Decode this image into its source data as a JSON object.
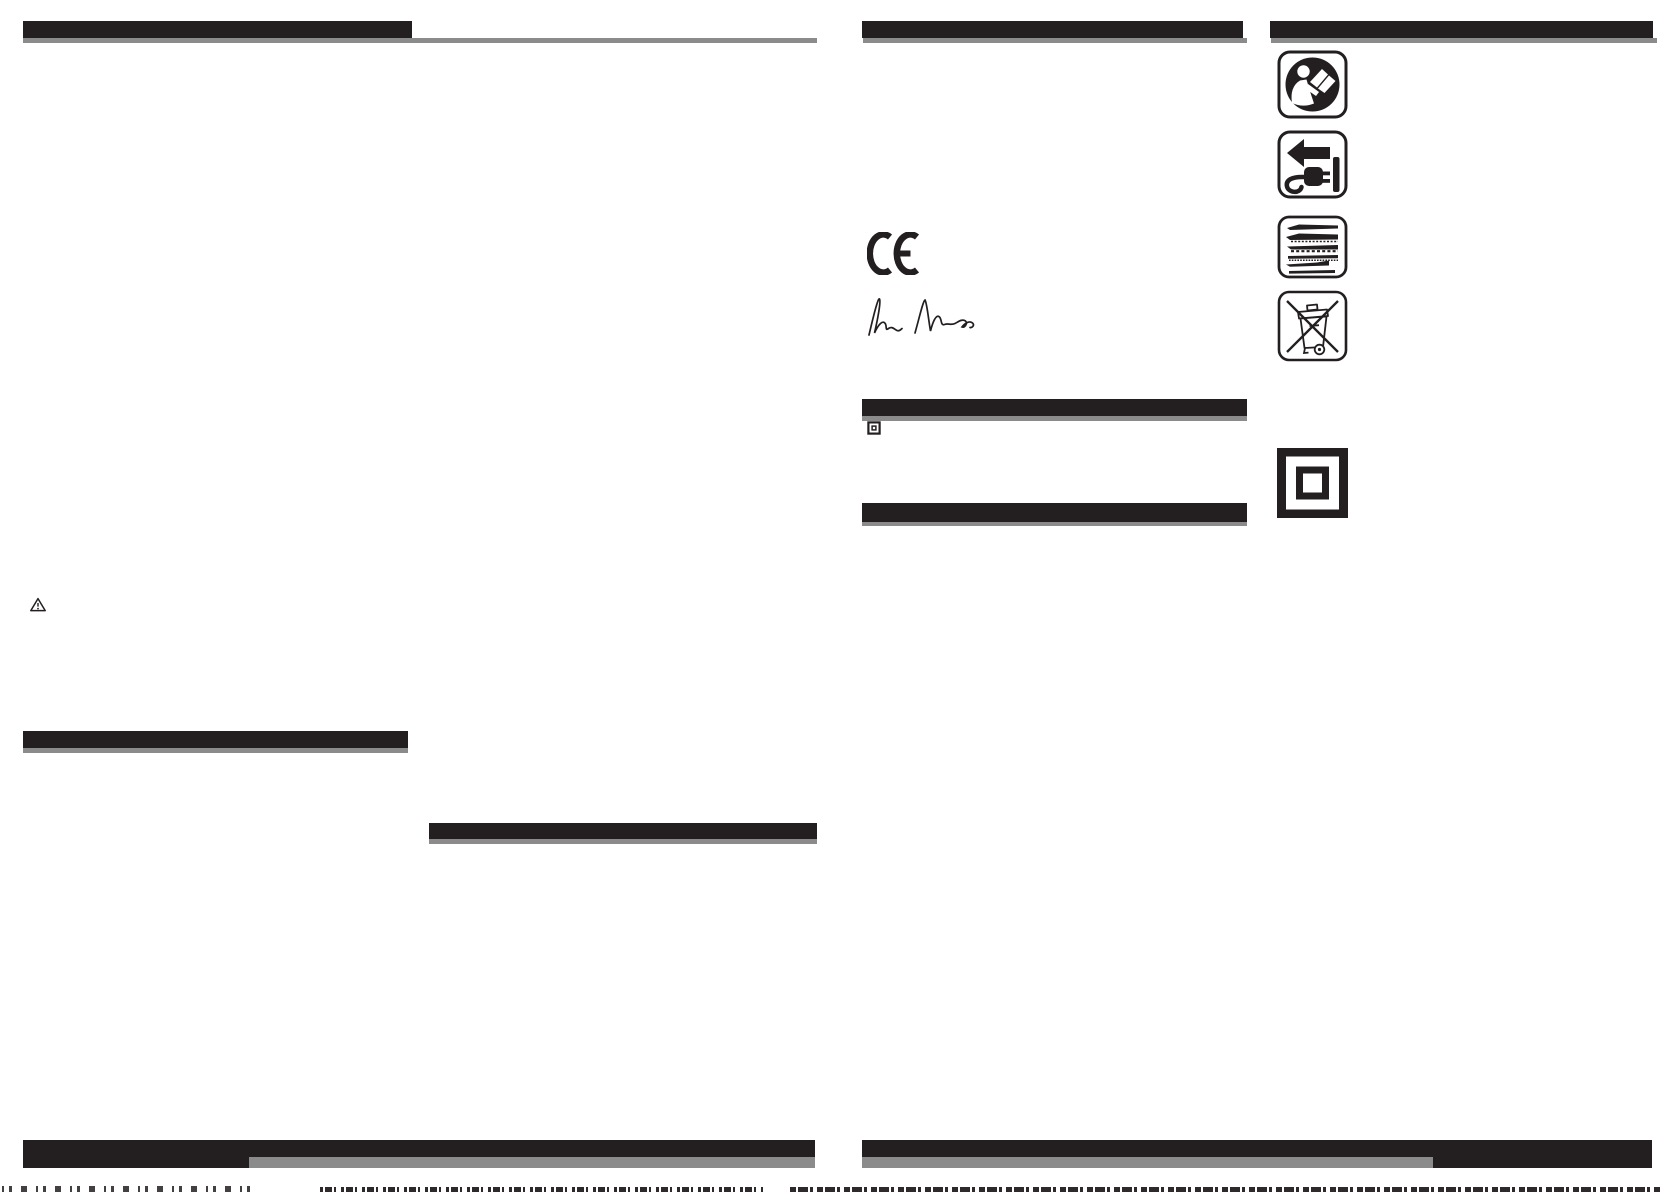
{
  "colors": {
    "ink": "#231f20",
    "bar_gray": "#8b8b8b",
    "paper": "#ffffff"
  },
  "ce_mark": {
    "label": "CE"
  },
  "signature": {
    "name": "handwritten-signature"
  },
  "icons": {
    "warning": {
      "name": "warning-triangle-icon"
    },
    "read_manual": {
      "name": "read-manual-icon"
    },
    "unplug": {
      "name": "disconnect-mains-plug-icon"
    },
    "saw_blades": {
      "name": "saw-blades-icon"
    },
    "weee": {
      "name": "crossed-out-wheelie-bin-icon"
    },
    "class2_small": {
      "name": "double-insulation-small-icon"
    },
    "class2_large": {
      "name": "double-insulation-icon"
    }
  }
}
